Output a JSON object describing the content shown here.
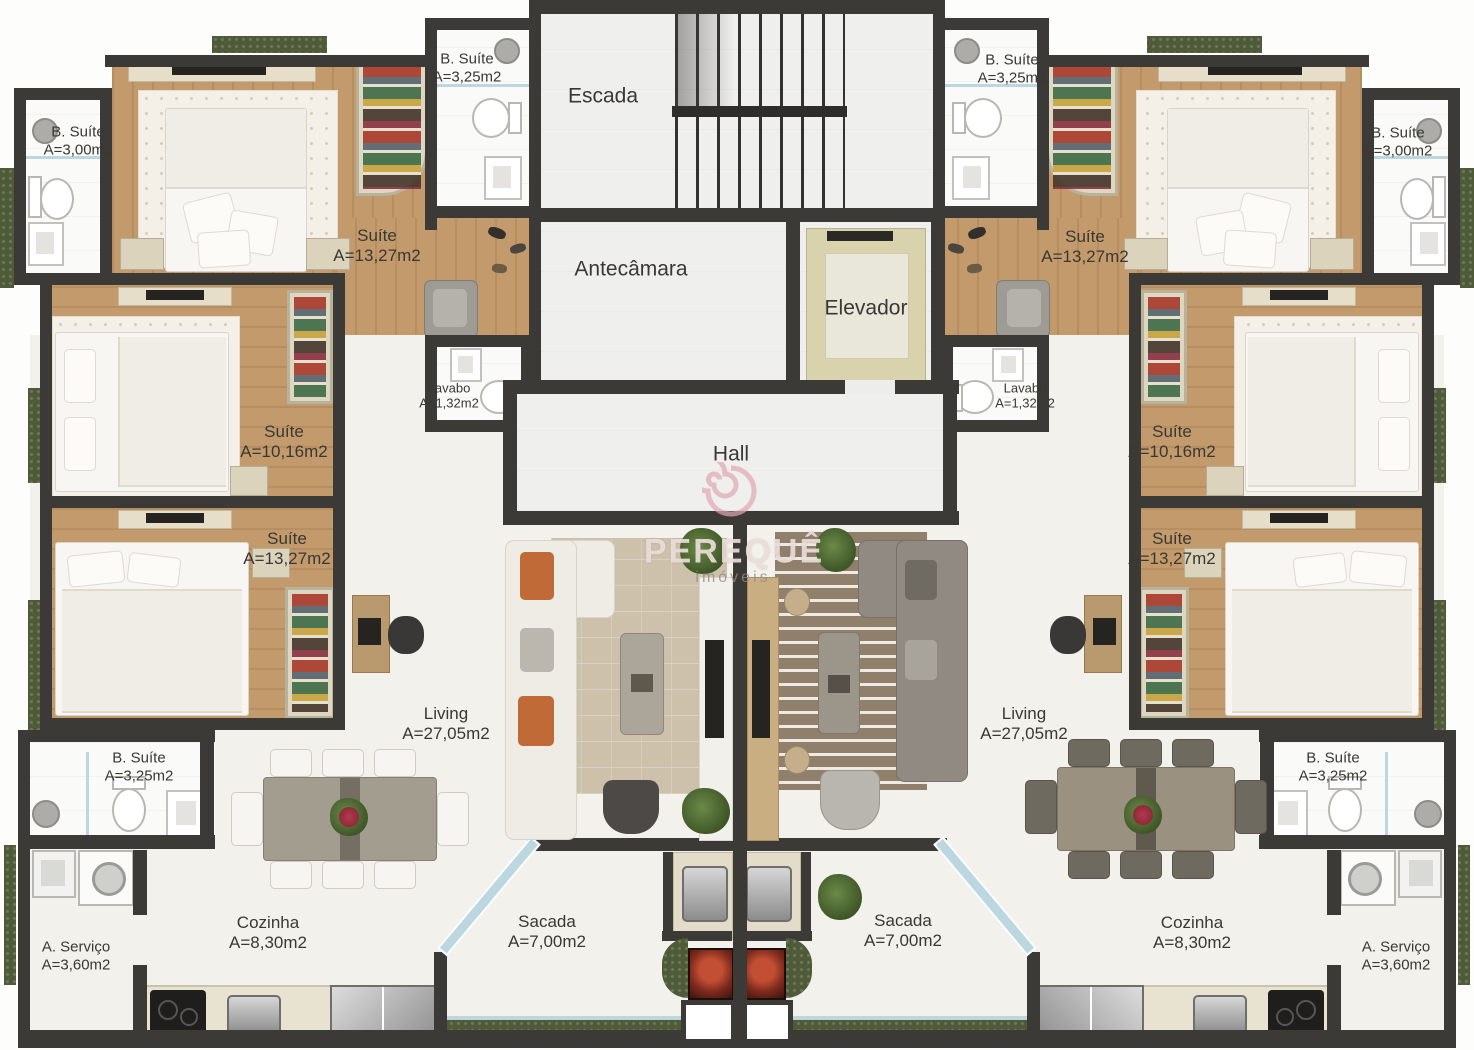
{
  "watermark": {
    "brand": "PEREQUÊ",
    "tagline": "imóveis"
  },
  "core_rooms": {
    "escada": "Escada",
    "antecamara": "Antecâmara",
    "elevador": "Elevador",
    "hall": "Hall"
  },
  "rooms": {
    "suite_13": {
      "name": "Suíte",
      "area": "A=13,27m2"
    },
    "suite_10": {
      "name": "Suíte",
      "area": "A=10,16m2"
    },
    "b_suite_300": {
      "name": "B. Suíte",
      "area": "A=3,00m2"
    },
    "b_suite_325": {
      "name": "B. Suíte",
      "area": "A=3,25m2"
    },
    "lavabo": {
      "name": "Lavabo",
      "area": "A=1,32m2"
    },
    "living": {
      "name": "Living",
      "area": "A=27,05m2"
    },
    "cozinha": {
      "name": "Cozinha",
      "area": "A=8,30m2"
    },
    "sacada": {
      "name": "Sacada",
      "area": "A=7,00m2"
    },
    "a_servico": {
      "name": "A. Serviço",
      "area": "A=3,60m2"
    }
  },
  "palette": {
    "wall": "#3C3A37",
    "wood": "#C29A6C",
    "floor_light": "#F3F1EC",
    "bath": "#FAFAF8",
    "elevator_car": "#D8D3AC",
    "glass": "#BDD7E1",
    "greenery": "#4F5B38",
    "watermark_pink": "#DFA8B2",
    "label_text": "#3A3833",
    "accent_orange": "#C06A38"
  }
}
